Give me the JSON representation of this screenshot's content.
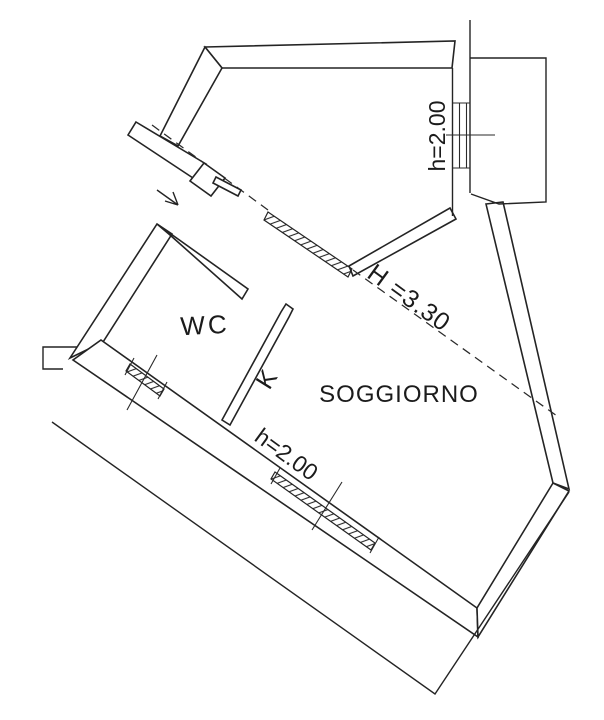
{
  "document": {
    "kind": "architectural floor plan (scanned drawing)"
  },
  "labels": {
    "room_wc": "WC",
    "room_kitchen": "K",
    "room_living": "SOGGIORNO",
    "height_window_top": "h=2.00",
    "height_window_bottom": "h=2.00",
    "height_ridge": "H =3.30"
  },
  "colors": {
    "line": "#242424",
    "text": "#1b1b1b",
    "background": "#ffffff"
  }
}
